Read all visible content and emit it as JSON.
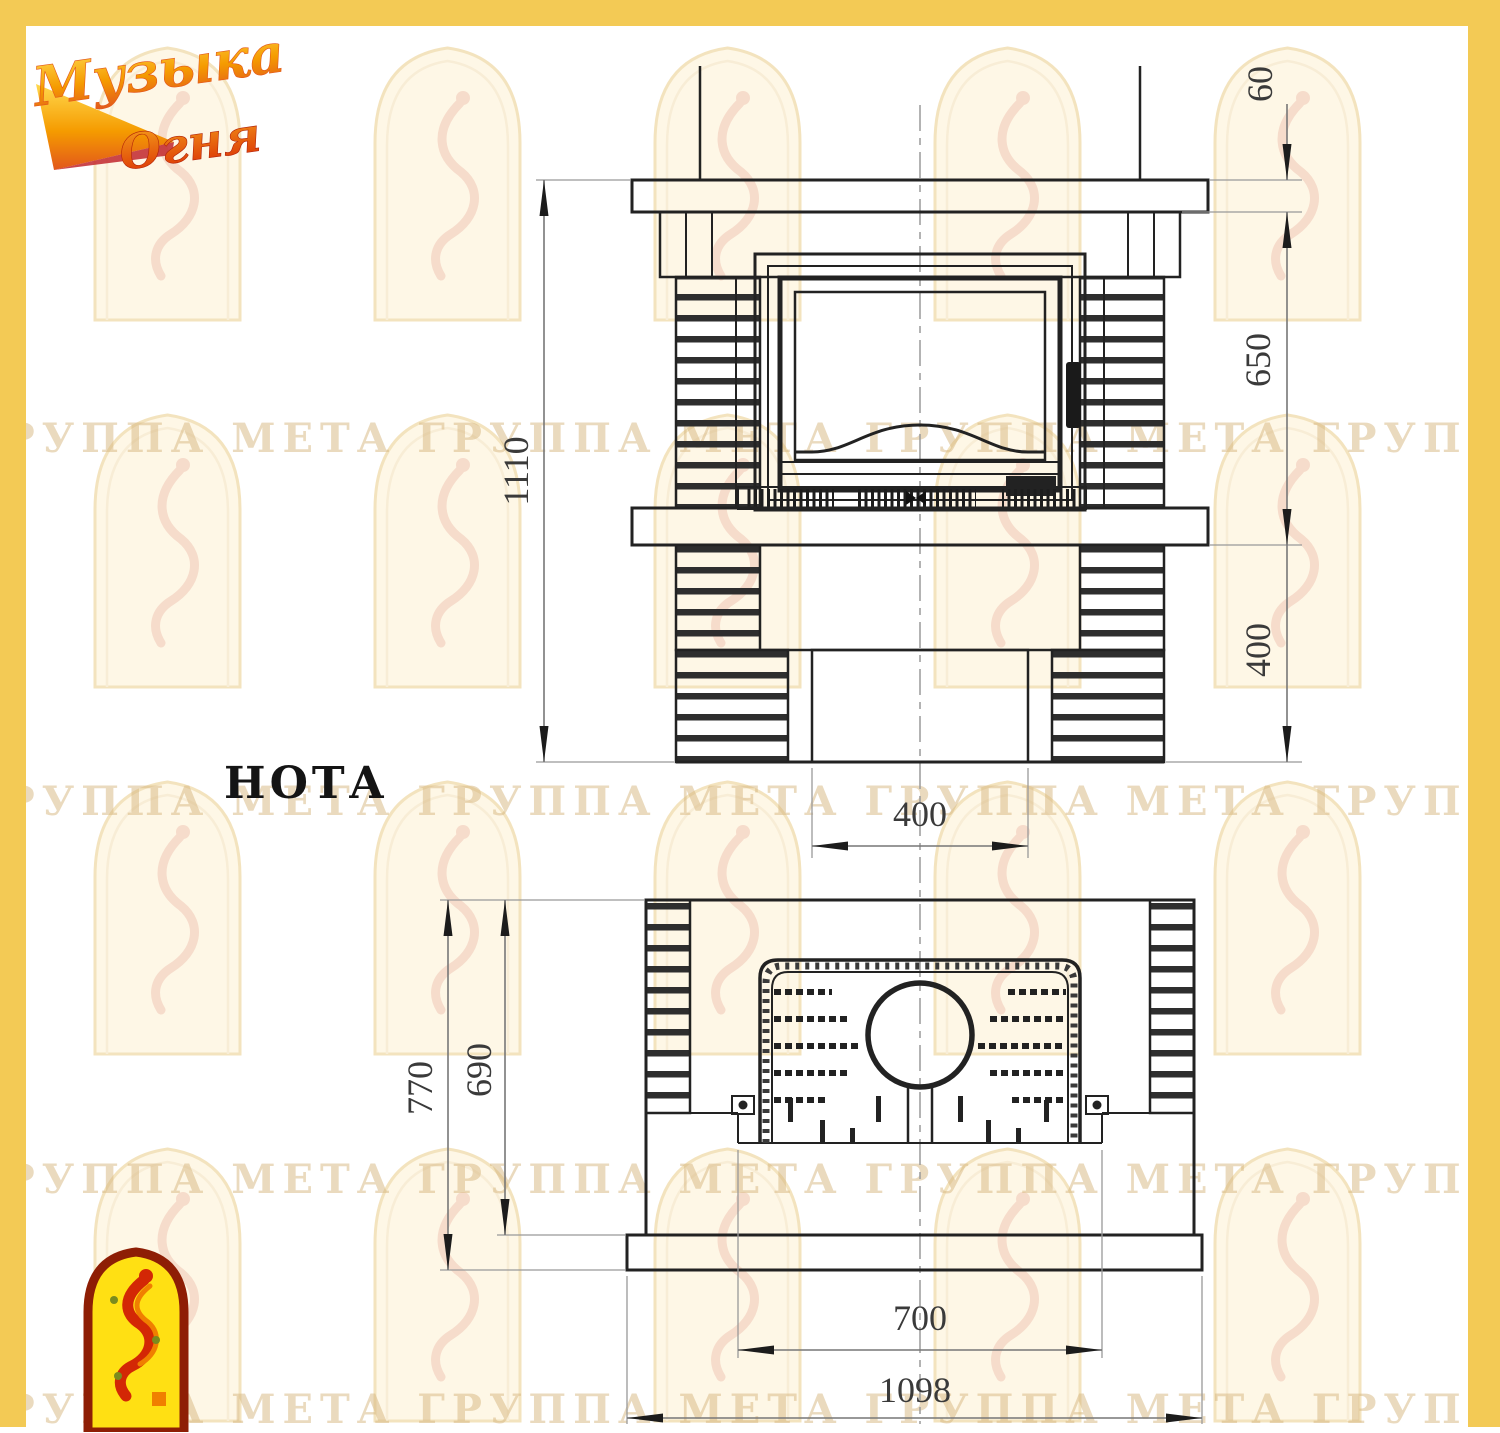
{
  "logo": {
    "line1": "Музыка",
    "line2": "Огня"
  },
  "title": "НОТА",
  "watermark": {
    "row_text": "ГРУППА МЕТА ГРУППА МЕТА ГРУППА МЕТА ГРУППА МЕТА ГРУППА МЕТА"
  },
  "front_view": {
    "dims": {
      "total_height": "1110",
      "mantel_thickness": "60",
      "firebox_zone_height": "650",
      "pedestal_height": "400",
      "plinth_width": "400"
    }
  },
  "plan_view": {
    "dims": {
      "total_depth": "770",
      "body_depth": "690",
      "opening_width": "700",
      "total_width": "1098"
    }
  },
  "colors": {
    "border": "#f3ca55",
    "line": "#222222",
    "dim_line": "#8a8a8a",
    "dim_text": "#3a3a3a",
    "watermark": "#d5b57e"
  }
}
